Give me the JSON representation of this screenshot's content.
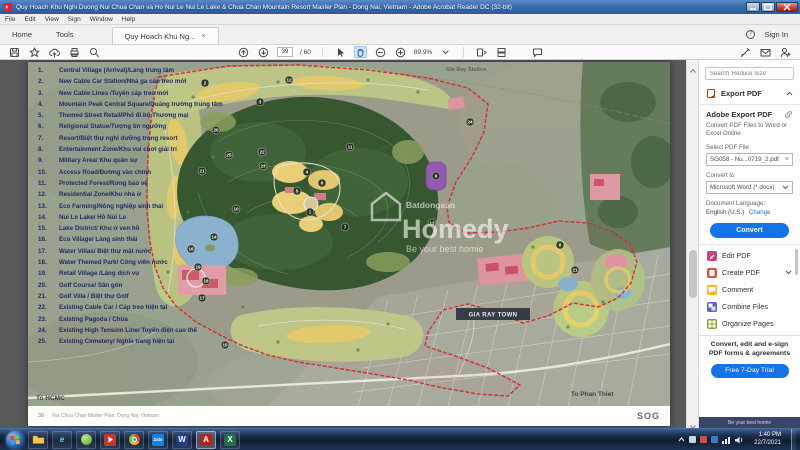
{
  "window": {
    "title": "Quy Hoach Khu Nghi Duong Nui Chua Chan va Ho Nui Le Nui Le Lake & Chua Chan Mountain Resort Master Plan - Dong Nai, Vietnam - Adobe Acrobat Reader DC (32-bit)"
  },
  "menu": {
    "items": [
      "File",
      "Edit",
      "View",
      "Sign",
      "Window",
      "Help"
    ]
  },
  "tabs": {
    "home": "Home",
    "tools": "Tools",
    "document": "Quy Hoach Khu Ng...",
    "close": "×",
    "help": "?",
    "sign_in": "Sign In"
  },
  "toolbar": {
    "page_current": "39",
    "page_total": "/ 60",
    "zoom_level": "89.9%"
  },
  "legend": {
    "items": [
      {
        "num": "1.",
        "text": "Central Village (Arrival)/Làng trung tâm"
      },
      {
        "num": "2.",
        "text": "New Cable Car Station/Nhà ga cáp treo mới"
      },
      {
        "num": "3.",
        "text": "New Cable Lines /Tuyến cáp treo mới"
      },
      {
        "num": "4.",
        "text": "Mountain Peak Central Square/Quảng trường trung tâm"
      },
      {
        "num": "5.",
        "text": "Themed Street Retail/Phố đi bộ Thương mại"
      },
      {
        "num": "6.",
        "text": "Religional Statue/Tượng tín ngưỡng"
      },
      {
        "num": "7.",
        "text": "Resort/Biệt thự nghỉ dưỡng trong resort"
      },
      {
        "num": "8.",
        "text": "Entertainment Zone/Khu vui chơi giải trí"
      },
      {
        "num": "9.",
        "text": "Military Area/ Khu quân sự"
      },
      {
        "num": "10.",
        "text": "Access Road/Đường vào chính"
      },
      {
        "num": "11.",
        "text": "Protected Forest/Rừng bảo vệ"
      },
      {
        "num": "12.",
        "text": "Residential Zone/Khu nhà ở"
      },
      {
        "num": "13.",
        "text": "Eco Farming/Nông nghiệp sinh thái"
      },
      {
        "num": "14.",
        "text": "Nui Le Lake/ Hồ Núi Le"
      },
      {
        "num": "15.",
        "text": "Lake District/ Khu ở ven hồ"
      },
      {
        "num": "16.",
        "text": "Eco Village/ Làng sinh thái"
      },
      {
        "num": "17.",
        "text": "Water Villas/ Biệt thự mặt nước"
      },
      {
        "num": "18.",
        "text": "Water Themed Park/ Công viên nước"
      },
      {
        "num": "19.",
        "text": "Retail Village /Làng dịch vụ"
      },
      {
        "num": "20.",
        "text": "Golf Course/ Sân gôn"
      },
      {
        "num": "21.",
        "text": "Golf Villa / Biệt thự Golf"
      },
      {
        "num": "22.",
        "text": "Existing Cable Car / Cáp treo hiện tại"
      },
      {
        "num": "23.",
        "text": "Existing Pagoda / Chùa"
      },
      {
        "num": "24.",
        "text": "Existing High Tension Line/ Tuyến điện cao thế"
      },
      {
        "num": "25.",
        "text": "Existing Cemetery/ Nghĩa trang hiện tại"
      }
    ]
  },
  "map": {
    "labels": {
      "station": "Gia Ray Station",
      "town": "GIA RAY TOWN",
      "to_hcmc": "To HCMC",
      "to_phan_thiet": "To Phan Thiet"
    },
    "watermark": {
      "brand_small": "Batdongsan",
      "brand_large": "Homedy",
      "tagline": "Be your best homie"
    },
    "markers": [
      "2",
      "12",
      "3",
      "24",
      "20",
      "11",
      "22",
      "25",
      "23",
      "21",
      "4",
      "9",
      "6",
      "5",
      "10",
      "1",
      "13",
      "7",
      "14",
      "16",
      "8",
      "19",
      "21",
      "18",
      "17",
      "15"
    ]
  },
  "page_footer": {
    "page_no": "38",
    "title": "Nui Chua Chan Master Plan, Dong Nai, Vietnam",
    "logo": "SOG"
  },
  "panel": {
    "search_placeholder": "Search 'Reduce Size'",
    "export_header": "Export PDF",
    "card": {
      "title": "Adobe Export PDF",
      "description": "Convert PDF Files to Word or Excel Online",
      "select_label": "Select PDF File",
      "file_name": "SG058 - Nu...0719_2.pdf",
      "remove": "×",
      "convert_to_label": "Convert to",
      "format": "Microsoft Word (*.docx)",
      "language_label": "Document Language:",
      "language": "English (U.S.)",
      "change": "Change",
      "convert_button": "Convert"
    },
    "tools": [
      {
        "label": "Edit PDF"
      },
      {
        "label": "Create PDF"
      },
      {
        "label": "Comment"
      },
      {
        "label": "Combine Files"
      },
      {
        "label": "Organize Pages"
      }
    ],
    "promo": "Convert, edit and e-sign PDF forms & agreements",
    "trial_button": "Free 7-Day Trial",
    "watermark": "Be your best homie"
  },
  "taskbar": {
    "time": "1:40 PM",
    "date": "22/7/2021",
    "glyphs": {
      "ie": "e",
      "zalo": "Zalo",
      "word": "W",
      "acrobat": "A",
      "excel": "X"
    }
  }
}
